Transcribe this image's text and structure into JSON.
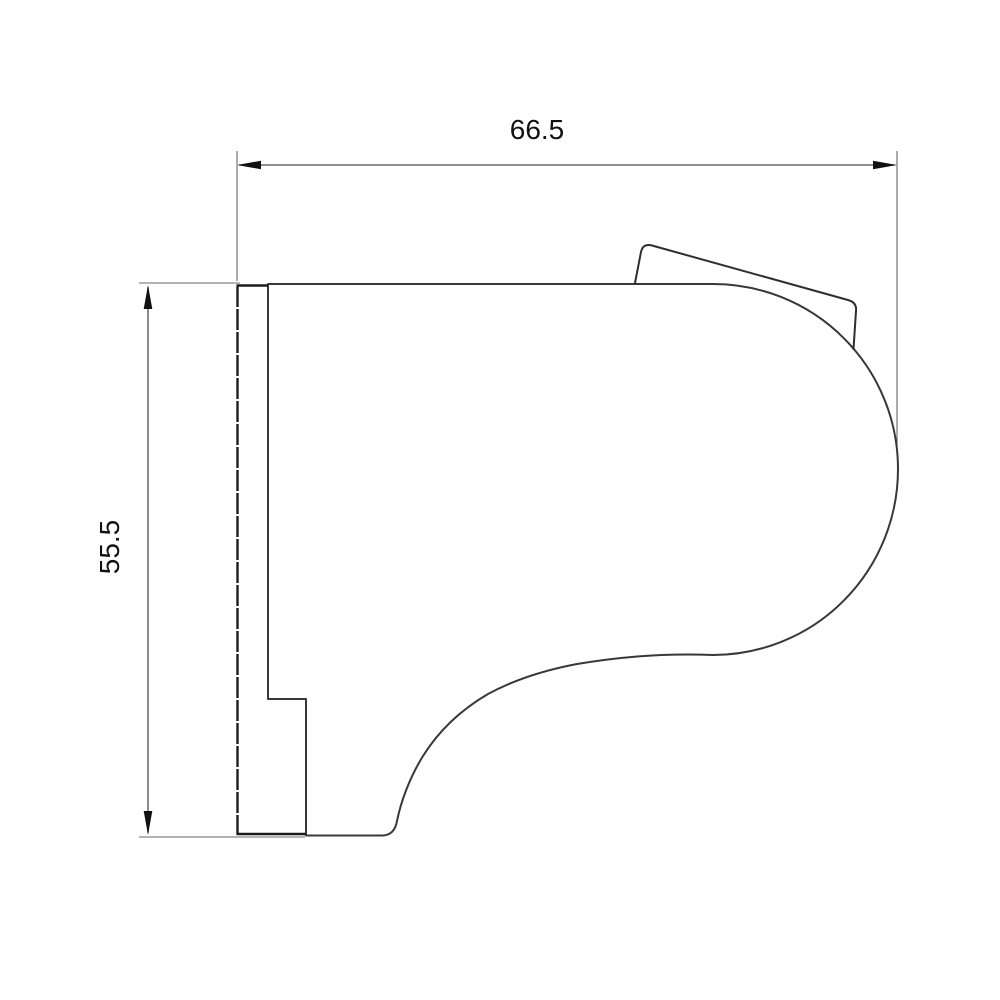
{
  "drawing": {
    "kind": "technical-dimension-drawing",
    "part": "side-profile-bracket-with-round-lobe",
    "dimensions": {
      "width": {
        "value": "66.5",
        "orientation": "horizontal"
      },
      "height": {
        "value": "55.5",
        "orientation": "vertical"
      }
    },
    "colors": {
      "background": "#ffffff",
      "outline": "#383838",
      "plate_edge": "#1c1c1c",
      "dimension_lines": "#4d4d4d",
      "label_text": "#111111"
    }
  }
}
